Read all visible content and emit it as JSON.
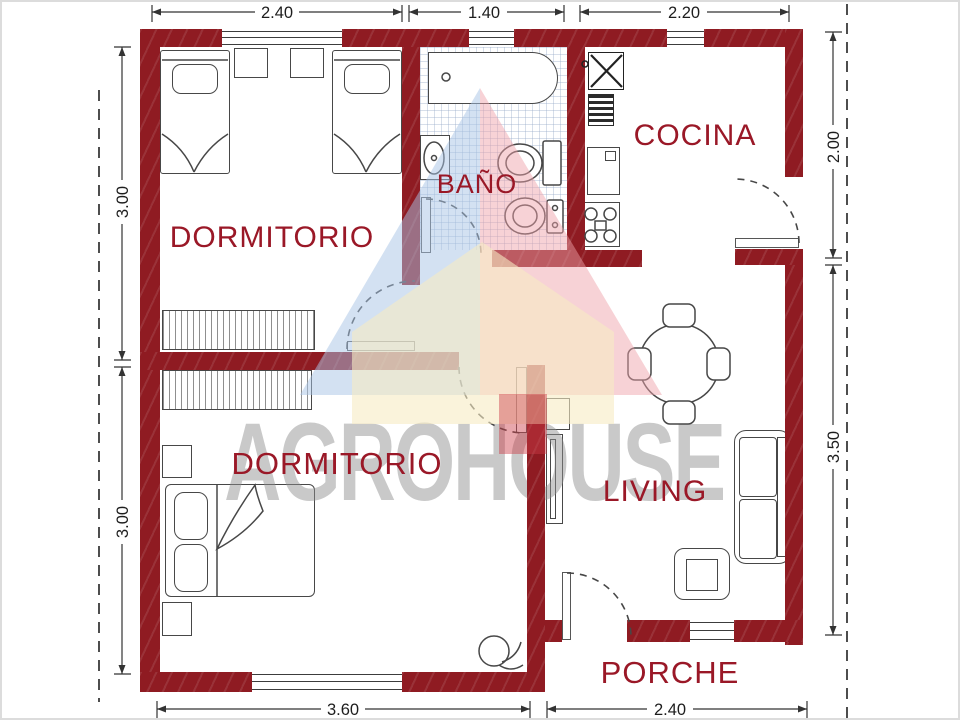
{
  "watermark": {
    "brand_text": "AGROHOUSE"
  },
  "rooms": {
    "dormitorio_top": {
      "label": "DORMITORIO"
    },
    "bano": {
      "label": "BAÑO"
    },
    "cocina": {
      "label": "COCINA"
    },
    "dormitorio_bottom": {
      "label": "DORMITORIO"
    },
    "living": {
      "label": "LIVING"
    },
    "porche": {
      "label": "PORCHE"
    }
  },
  "dimensions": {
    "top": [
      {
        "value": "2.40"
      },
      {
        "value": "1.40"
      },
      {
        "value": "2.20"
      }
    ],
    "left": [
      {
        "value": "3.00"
      },
      {
        "value": "3.00"
      }
    ],
    "right": [
      {
        "value": "2.00"
      },
      {
        "value": "3.50"
      }
    ],
    "bottom": [
      {
        "value": "3.60"
      },
      {
        "value": "2.40"
      }
    ]
  },
  "colors": {
    "wall": "#8f1b22",
    "room_label": "#9a1827",
    "dimension_text": "#1d1d1d",
    "watermark_gray": "#8f8f8f",
    "logo_blue": "#a7c4e5",
    "logo_pink": "#eea0aa",
    "logo_cream": "#f7ebc3",
    "logo_red": "#cd3c46"
  },
  "furniture": {
    "dormitorio_top": [
      "single-bed",
      "single-bed",
      "nightstand",
      "nightstand",
      "wardrobe"
    ],
    "bano": [
      "bathtub",
      "washbasin",
      "toilet",
      "bidet"
    ],
    "cocina": [
      "laundry-sink",
      "dish-rack",
      "counter-sink",
      "stove"
    ],
    "dining": [
      "round-table",
      "chair",
      "chair",
      "chair",
      "chair"
    ],
    "living": [
      "sofa",
      "armchair",
      "shelf",
      "tv-cabinet"
    ],
    "dormitorio_bottom": [
      "double-bed",
      "nightstand",
      "nightstand",
      "wardrobe",
      "plant"
    ]
  }
}
